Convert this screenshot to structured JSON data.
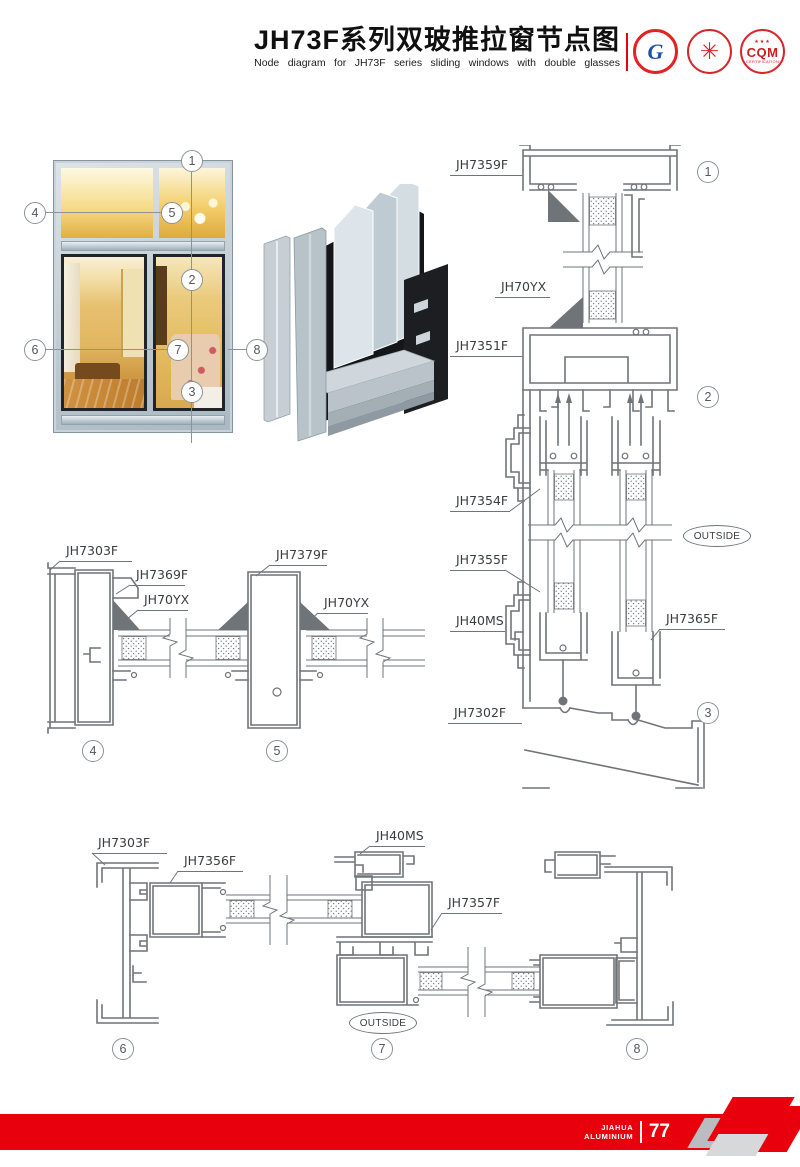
{
  "header": {
    "title_cn": "JH73F系列双玻推拉窗节点图",
    "title_en": "Node diagram for JH73F series sliding windows with double glasses",
    "logos": [
      {
        "name": "gb-certification-logo",
        "text": "G"
      },
      {
        "name": "star-seal-logo",
        "text": "✳"
      },
      {
        "name": "cqm-logo",
        "stars": "★★★",
        "text": "CQM",
        "sub": "CERTIFICATION"
      }
    ]
  },
  "photo": {
    "callouts": [
      "1",
      "2",
      "3",
      "4",
      "5",
      "6",
      "7",
      "8"
    ]
  },
  "diagram_right": {
    "labels": {
      "jh7359f": "JH7359F",
      "jh70yx": "JH70YX",
      "jh7351f": "JH7351F",
      "jh7354f": "JH7354F",
      "jh7355f": "JH7355F",
      "jh40ms": "JH40MS",
      "jh7365f": "JH7365F",
      "jh7302f": "JH7302F"
    },
    "outside_label": "OUTSIDE",
    "section_markers": [
      "1",
      "2",
      "3"
    ]
  },
  "diagram_mid": {
    "labels": {
      "jh7303f": "JH7303F",
      "jh7369f": "JH7369F",
      "jh70yx": "JH70YX",
      "jh7379f": "JH7379F",
      "jh70yx_2": "JH70YX"
    },
    "section_markers": [
      "4",
      "5"
    ]
  },
  "diagram_bottom": {
    "labels": {
      "jh7303f": "JH7303F",
      "jh7356f": "JH7356F",
      "jh40ms": "JH40MS",
      "jh7357f": "JH7357F"
    },
    "outside_label": "OUTSIDE",
    "section_markers": [
      "6",
      "7",
      "8"
    ]
  },
  "footer": {
    "brand_top": "JIAHUA",
    "brand_bottom": "ALUMINIUM",
    "page_number": "77"
  },
  "colors": {
    "accent_red": "#e60012",
    "line_gray": "#6f7478"
  }
}
